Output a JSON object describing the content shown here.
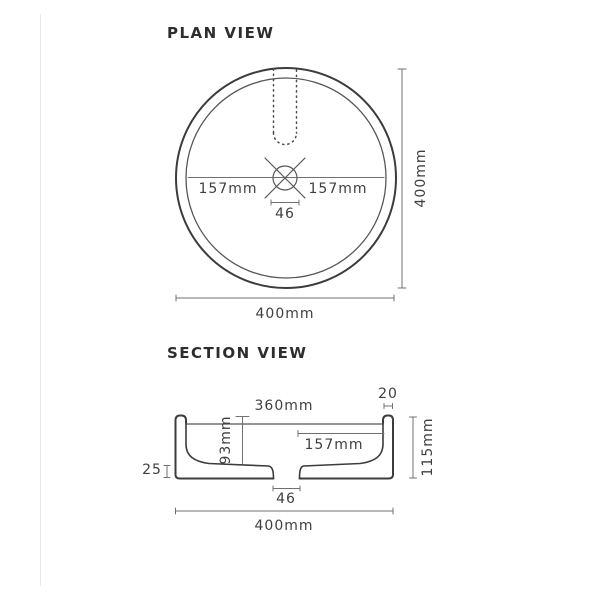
{
  "colors": {
    "background": "#ffffff",
    "outline": "#3c3c3c",
    "secondary_line": "#565656",
    "dimension_line": "#707070",
    "text": "#3f3f3f"
  },
  "plan_view": {
    "title": "PLAN VIEW",
    "dimensions": {
      "center_to_rim_left": "157mm",
      "center_to_rim_right": "157mm",
      "drain_diameter": "46",
      "overall_height": "400mm",
      "overall_width": "400mm"
    }
  },
  "section_view": {
    "title": "SECTION VIEW",
    "dimensions": {
      "wall_thickness": "20",
      "inner_width": "360mm",
      "bowl_depth": "93mm",
      "center_to_wall": "157mm",
      "base_lip_height": "25",
      "overall_height": "115mm",
      "drain_width": "46",
      "overall_width": "400mm"
    }
  }
}
